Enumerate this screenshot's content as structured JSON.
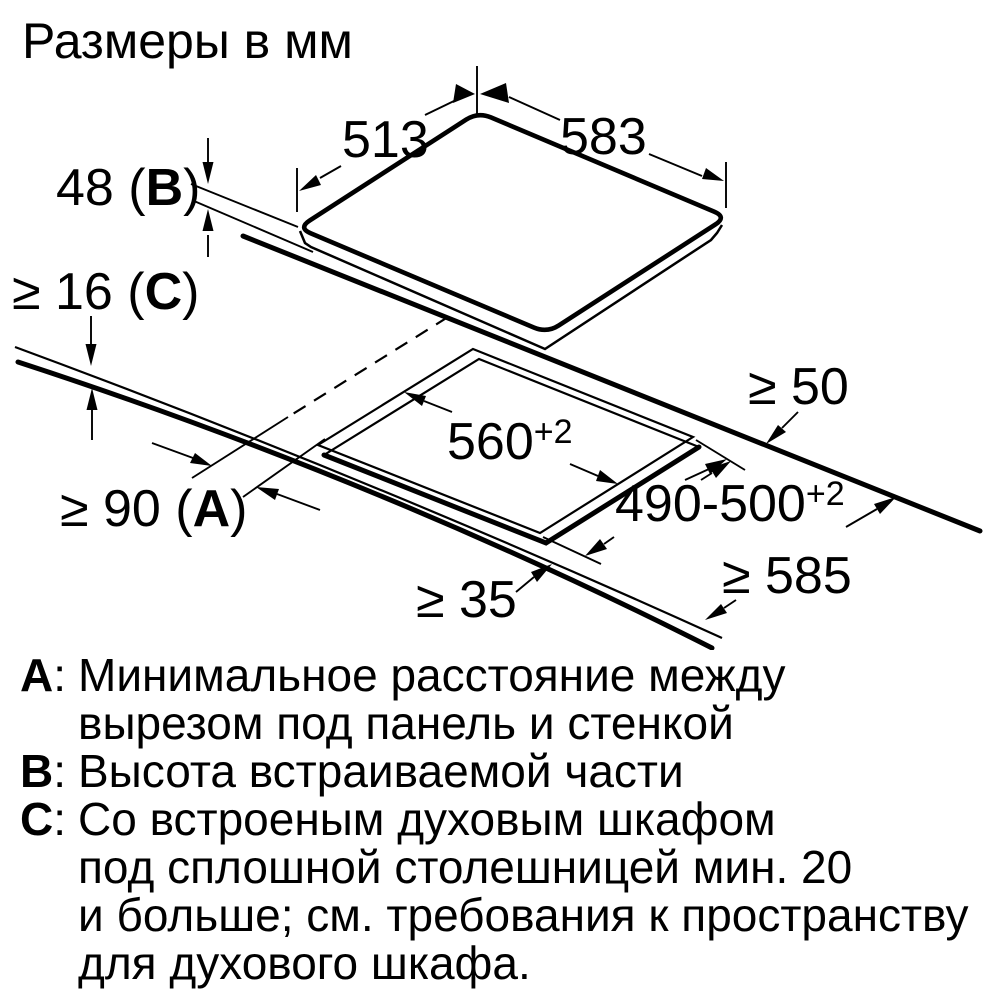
{
  "title": "Размеры в мм",
  "colors": {
    "ink": "#000000",
    "background": "#ffffff"
  },
  "diagram": {
    "dims": {
      "panel_depth": "513",
      "panel_width": "583",
      "panel_height": {
        "pre": "48 (",
        "key": "B",
        "post": ")"
      },
      "worktop_thickness": {
        "pre": "≥ 16 (",
        "key": "C",
        "post": ")"
      },
      "side_clearance": {
        "pre": "≥ 90 (",
        "key": "A",
        "post": ")"
      },
      "rear_clearance": "≥ 50",
      "cutout_width": {
        "base": "560",
        "sup": "+2"
      },
      "cutout_depth": {
        "base": "490-500",
        "sup": "+2"
      },
      "front_clearance": "≥ 35",
      "worktop_depth": "≥ 585"
    }
  },
  "legend": [
    {
      "letter": "A",
      "sep": ":",
      "text": "Минимальное расстояние между"
    },
    {
      "letter": "",
      "sep": "",
      "text": "вырезом под панель и стенкой"
    },
    {
      "letter": "B",
      "sep": ":",
      "text": "Высота встраиваемой части"
    },
    {
      "letter": "C",
      "sep": ":",
      "text": "Со встроеным духовым шкафом"
    },
    {
      "letter": "",
      "sep": "",
      "text": "под сплошной столешницей мин. 20"
    },
    {
      "letter": "",
      "sep": "",
      "text": "и больше; см. требования к пространству"
    },
    {
      "letter": "",
      "sep": "",
      "text": "для духового шкафа."
    }
  ]
}
